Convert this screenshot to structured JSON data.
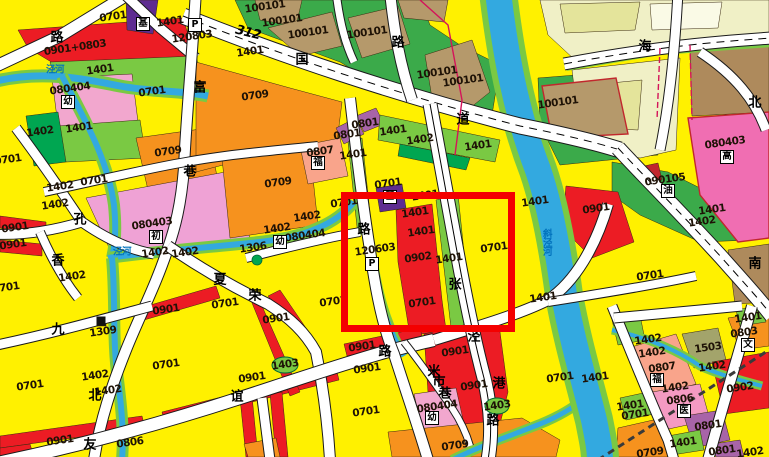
{
  "map": {
    "title": "urban land-use zoning map",
    "palette": {
      "residential_yellow": "#FFF100",
      "commercial_red": "#EC1C24",
      "industrial_orange": "#F6921E",
      "school_pink": "#EFA2D5",
      "utility_purple": "#A864A8",
      "religious_purple": "#5E2C91",
      "green_space": "#7AC943",
      "dark_green": "#00A651",
      "village_tan": "#B5996B",
      "water_blue": "#33A9E0",
      "built_pale": "#F0F0C6",
      "highlight_red": "#F40000"
    },
    "highlight_box": {
      "x": 341,
      "y": 192,
      "w": 160,
      "h": 126,
      "color": "#F40000"
    },
    "highway_label": {
      "t": "312",
      "x": 248,
      "y": 33
    },
    "parcel_labels": [
      {
        "t": "0701",
        "x": 113,
        "y": 17
      },
      {
        "t": "0701",
        "x": 152,
        "y": 92
      },
      {
        "t": "0701",
        "x": 8,
        "y": 160
      },
      {
        "t": "0701",
        "x": 94,
        "y": 181
      },
      {
        "t": "0701",
        "x": 6,
        "y": 288
      },
      {
        "t": "0701",
        "x": 30,
        "y": 386
      },
      {
        "t": "0701",
        "x": 166,
        "y": 365
      },
      {
        "t": "0701",
        "x": 225,
        "y": 304
      },
      {
        "t": "0701",
        "x": 333,
        "y": 302
      },
      {
        "t": "0701",
        "x": 388,
        "y": 184
      },
      {
        "t": "0701",
        "x": 344,
        "y": 203
      },
      {
        "t": "0701",
        "x": 422,
        "y": 303
      },
      {
        "t": "0701",
        "x": 494,
        "y": 248
      },
      {
        "t": "0701",
        "x": 366,
        "y": 412
      },
      {
        "t": "0701",
        "x": 650,
        "y": 276
      },
      {
        "t": "0701",
        "x": 560,
        "y": 378
      },
      {
        "t": "0701",
        "x": 635,
        "y": 415
      },
      {
        "t": "0709",
        "x": 255,
        "y": 96
      },
      {
        "t": "0709",
        "x": 168,
        "y": 152
      },
      {
        "t": "0709",
        "x": 278,
        "y": 183
      },
      {
        "t": "0709",
        "x": 455,
        "y": 446
      },
      {
        "t": "0709",
        "x": 650,
        "y": 453
      },
      {
        "t": "0901+0803",
        "x": 75,
        "y": 48
      },
      {
        "t": "0901",
        "x": 15,
        "y": 228
      },
      {
        "t": "0901",
        "x": 13,
        "y": 245
      },
      {
        "t": "0901",
        "x": 166,
        "y": 310
      },
      {
        "t": "0901",
        "x": 276,
        "y": 319
      },
      {
        "t": "0901",
        "x": 252,
        "y": 378
      },
      {
        "t": "0901",
        "x": 60,
        "y": 441
      },
      {
        "t": "0901",
        "x": 362,
        "y": 347
      },
      {
        "t": "0901",
        "x": 367,
        "y": 369
      },
      {
        "t": "0901",
        "x": 455,
        "y": 352
      },
      {
        "t": "0901",
        "x": 474,
        "y": 386
      },
      {
        "t": "0901",
        "x": 596,
        "y": 209
      },
      {
        "t": "0902",
        "x": 418,
        "y": 258
      },
      {
        "t": "0902",
        "x": 740,
        "y": 388
      },
      {
        "t": "1401",
        "x": 100,
        "y": 70
      },
      {
        "t": "1401",
        "x": 79,
        "y": 128
      },
      {
        "t": "1401",
        "x": 170,
        "y": 22
      },
      {
        "t": "1401",
        "x": 250,
        "y": 52
      },
      {
        "t": "1401",
        "x": 353,
        "y": 155
      },
      {
        "t": "1401",
        "x": 393,
        "y": 131
      },
      {
        "t": "1401",
        "x": 478,
        "y": 146
      },
      {
        "t": "1401",
        "x": 425,
        "y": 196
      },
      {
        "t": "1401",
        "x": 415,
        "y": 213
      },
      {
        "t": "1401",
        "x": 421,
        "y": 232
      },
      {
        "t": "1401",
        "x": 449,
        "y": 259
      },
      {
        "t": "1401",
        "x": 535,
        "y": 202
      },
      {
        "t": "1401",
        "x": 543,
        "y": 298
      },
      {
        "t": "1401",
        "x": 712,
        "y": 210
      },
      {
        "t": "1401",
        "x": 748,
        "y": 318
      },
      {
        "t": "1401",
        "x": 595,
        "y": 378
      },
      {
        "t": "1401",
        "x": 630,
        "y": 406
      },
      {
        "t": "1401",
        "x": 683,
        "y": 443
      },
      {
        "t": "1402",
        "x": 40,
        "y": 132
      },
      {
        "t": "1402",
        "x": 60,
        "y": 187
      },
      {
        "t": "1402",
        "x": 55,
        "y": 205
      },
      {
        "t": "1402",
        "x": 155,
        "y": 253
      },
      {
        "t": "1402",
        "x": 185,
        "y": 253
      },
      {
        "t": "1402",
        "x": 72,
        "y": 277
      },
      {
        "t": "1402",
        "x": 307,
        "y": 217
      },
      {
        "t": "1402",
        "x": 277,
        "y": 229
      },
      {
        "t": "1402",
        "x": 702,
        "y": 222
      },
      {
        "t": "1402",
        "x": 420,
        "y": 140
      },
      {
        "t": "1402",
        "x": 648,
        "y": 340
      },
      {
        "t": "1402",
        "x": 652,
        "y": 353
      },
      {
        "t": "1402",
        "x": 675,
        "y": 388
      },
      {
        "t": "1402",
        "x": 712,
        "y": 367
      },
      {
        "t": "1402",
        "x": 95,
        "y": 376
      },
      {
        "t": "1402",
        "x": 108,
        "y": 391
      },
      {
        "t": "1402",
        "x": 750,
        "y": 453
      },
      {
        "t": "1403",
        "x": 285,
        "y": 365
      },
      {
        "t": "1403",
        "x": 497,
        "y": 406
      },
      {
        "t": "1306",
        "x": 253,
        "y": 248
      },
      {
        "t": "1309",
        "x": 103,
        "y": 332
      },
      {
        "t": "1503",
        "x": 708,
        "y": 348
      },
      {
        "t": "100101",
        "x": 265,
        "y": 7
      },
      {
        "t": "100101",
        "x": 282,
        "y": 21
      },
      {
        "t": "100101",
        "x": 308,
        "y": 33
      },
      {
        "t": "100101",
        "x": 367,
        "y": 33
      },
      {
        "t": "100101",
        "x": 437,
        "y": 73
      },
      {
        "t": "100101",
        "x": 463,
        "y": 81
      },
      {
        "t": "100101",
        "x": 558,
        "y": 103
      },
      {
        "t": "080403",
        "x": 152,
        "y": 224
      },
      {
        "t": "080403",
        "x": 725,
        "y": 143
      },
      {
        "t": "080404",
        "x": 70,
        "y": 89
      },
      {
        "t": "080404",
        "x": 305,
        "y": 236
      },
      {
        "t": "080404",
        "x": 437,
        "y": 407
      },
      {
        "t": "0801",
        "x": 347,
        "y": 135
      },
      {
        "t": "0801",
        "x": 365,
        "y": 124
      },
      {
        "t": "0801",
        "x": 708,
        "y": 426
      },
      {
        "t": "0801",
        "x": 722,
        "y": 451
      },
      {
        "t": "0803",
        "x": 744,
        "y": 333
      },
      {
        "t": "0806",
        "x": 130,
        "y": 443
      },
      {
        "t": "0806",
        "x": 680,
        "y": 400
      },
      {
        "t": "0807",
        "x": 320,
        "y": 152
      },
      {
        "t": "0807",
        "x": 662,
        "y": 368
      },
      {
        "t": "090105",
        "x": 665,
        "y": 180
      },
      {
        "t": "120803",
        "x": 192,
        "y": 37
      },
      {
        "t": "120603",
        "x": 375,
        "y": 250
      }
    ],
    "road_chars": [
      {
        "t": "路",
        "x": 57,
        "y": 38
      },
      {
        "t": "富",
        "x": 200,
        "y": 88
      },
      {
        "t": "巷",
        "x": 190,
        "y": 172
      },
      {
        "t": "孔",
        "x": 80,
        "y": 220
      },
      {
        "t": "香",
        "x": 58,
        "y": 261
      },
      {
        "t": "夏",
        "x": 220,
        "y": 280
      },
      {
        "t": "荣",
        "x": 255,
        "y": 296
      },
      {
        "t": "九",
        "x": 58,
        "y": 330
      },
      {
        "t": "北",
        "x": 95,
        "y": 396
      },
      {
        "t": "友",
        "x": 90,
        "y": 445
      },
      {
        "t": "谊",
        "x": 237,
        "y": 397
      },
      {
        "t": "路",
        "x": 385,
        "y": 352
      },
      {
        "t": "路",
        "x": 364,
        "y": 230
      },
      {
        "t": "国",
        "x": 302,
        "y": 60
      },
      {
        "t": "道",
        "x": 463,
        "y": 120
      },
      {
        "t": "海",
        "x": 645,
        "y": 47
      },
      {
        "t": "北",
        "x": 755,
        "y": 103
      },
      {
        "t": "南",
        "x": 755,
        "y": 264
      },
      {
        "t": "路",
        "x": 398,
        "y": 43
      },
      {
        "t": "张",
        "x": 455,
        "y": 285
      },
      {
        "t": "泾",
        "x": 474,
        "y": 337
      },
      {
        "t": "港",
        "x": 499,
        "y": 384
      },
      {
        "t": "路",
        "x": 493,
        "y": 421
      },
      {
        "t": "米",
        "x": 434,
        "y": 372
      },
      {
        "t": "市",
        "x": 439,
        "y": 382
      },
      {
        "t": "巷",
        "x": 445,
        "y": 394
      }
    ],
    "river_labels": [
      {
        "t": "泾河",
        "x": 55,
        "y": 70,
        "vert": false
      },
      {
        "t": "泾河",
        "x": 122,
        "y": 252,
        "vert": false
      },
      {
        "t": "斜泾河",
        "x": 546,
        "y": 242,
        "vert": true
      }
    ],
    "facility_icons": [
      {
        "t": "幼",
        "n": "kindergarten-icon",
        "x": 68,
        "y": 102
      },
      {
        "t": "幼",
        "n": "kindergarten-icon",
        "x": 280,
        "y": 242
      },
      {
        "t": "幼",
        "n": "kindergarten-icon",
        "x": 432,
        "y": 418
      },
      {
        "t": "初",
        "n": "junior-high-school-icon",
        "x": 156,
        "y": 237
      },
      {
        "t": "高",
        "n": "high-school-icon",
        "x": 727,
        "y": 157
      },
      {
        "t": "福",
        "n": "welfare-icon",
        "x": 318,
        "y": 163
      },
      {
        "t": "福",
        "n": "welfare-icon",
        "x": 657,
        "y": 380
      },
      {
        "t": "医",
        "n": "hospital-icon",
        "x": 684,
        "y": 411
      },
      {
        "t": "文",
        "n": "cultural-icon",
        "x": 748,
        "y": 345
      },
      {
        "t": "油",
        "n": "gas-station-icon",
        "x": 668,
        "y": 191
      },
      {
        "t": "基",
        "n": "church-icon",
        "x": 390,
        "y": 197
      },
      {
        "t": "基",
        "n": "church-icon",
        "x": 143,
        "y": 24
      }
    ],
    "parking_icons": [
      {
        "t": "P",
        "x": 195,
        "y": 25
      },
      {
        "t": "P",
        "x": 372,
        "y": 264
      }
    ],
    "markers": [
      {
        "n": "pump-station-icon",
        "x": 101,
        "y": 321
      }
    ]
  }
}
